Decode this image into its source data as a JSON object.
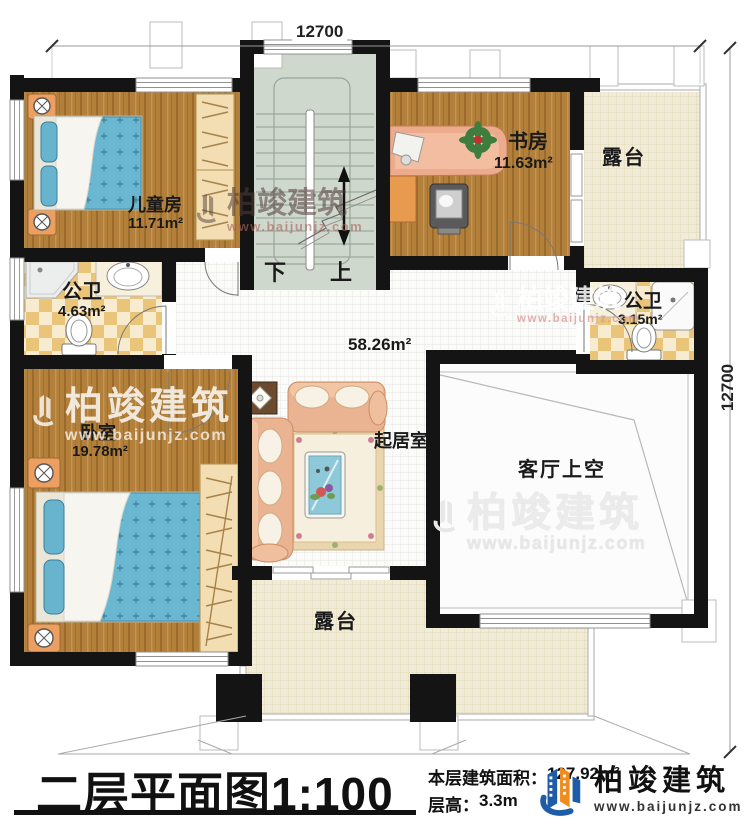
{
  "dimensions": {
    "top": "12700",
    "right": "12700"
  },
  "rooms": {
    "children": {
      "name": "儿童房",
      "area": "11.71m²"
    },
    "study": {
      "name": "书房",
      "area": "11.63m²"
    },
    "terrace_top": {
      "name": "露台"
    },
    "bath_left": {
      "name": "公卫",
      "area": "4.63m²"
    },
    "bath_right": {
      "name": "公卫",
      "area": "3.15m²"
    },
    "bedroom": {
      "name": "卧室",
      "area": "19.78m²"
    },
    "living": {
      "name": "起居室",
      "area": "58.26m²"
    },
    "void": {
      "name": "客厅上空"
    },
    "terrace_bottom": {
      "name": "露台"
    }
  },
  "stairs": {
    "down": "下",
    "up": "上"
  },
  "titlebar": {
    "plan_name": "二层平面图",
    "scale": "1:100",
    "area_label": "本层建筑面积：",
    "area_value": "127.92m²",
    "height_label": "层高：",
    "height_value": "3.3m"
  },
  "brand": {
    "name": "柏竣建筑",
    "url": "www.baijunjz.com"
  },
  "watermark": {
    "name": "柏竣建筑",
    "url": "www.baijunjz.com"
  },
  "colors": {
    "wall": "#141414",
    "wood": "#b2803a",
    "bed_blue": "#6ab7d2",
    "logo_blue": "#1e5ca8",
    "logo_orange": "#f08c1e"
  }
}
